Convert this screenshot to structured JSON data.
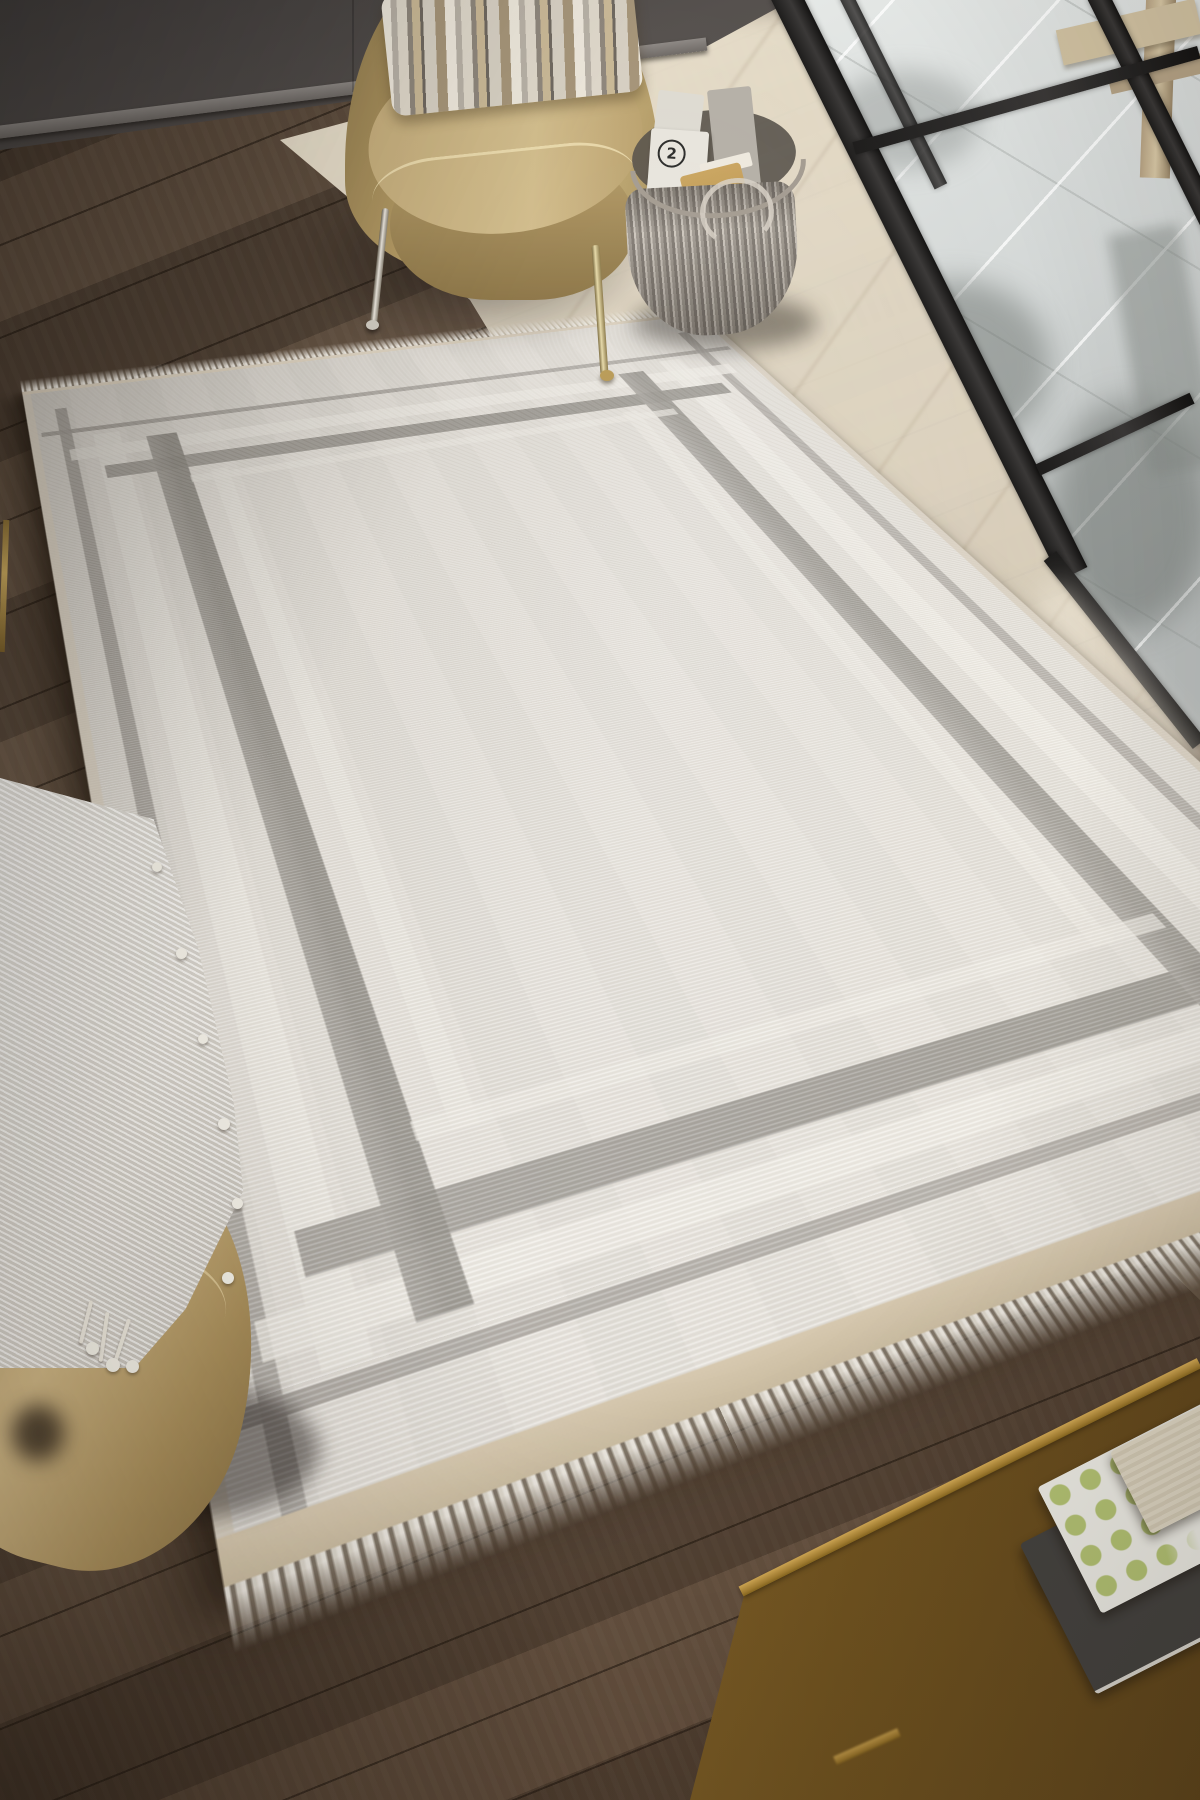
{
  "scene": {
    "description": "Overhead photo of a cream area rug with interlocking grey border frame in a living room",
    "magazine_badge": "2",
    "objects": {
      "rug": "cream ribbed rug, grey geometric border, fringed ends",
      "chair": "tan velvet barrel chair with striped pillow and metal legs",
      "basket": "grey woven basket holding magazines and a tan book",
      "windows": "black framed glass doors onto pale stone patio with wooden bench",
      "throw": "white fringed throw blanket",
      "ottoman": "tan ottoman corner",
      "table": "brass-edged coffee table with stacked books"
    },
    "palette": {
      "rug_field": "#e9e5de",
      "rug_pattern_grey": "#949089",
      "rug_ivory_band": "#f4f1ea",
      "floor_dark": "#57473a",
      "floor_light": "#e4d9c2",
      "wall": "#55504d",
      "chair_tan": "#c5ad7b",
      "window_frame": "#2a2928",
      "glass": "#d3d7d6",
      "brass": "#c9a24e",
      "throw_white": "#eeece6",
      "book_accent_green": "#b3c273"
    }
  }
}
